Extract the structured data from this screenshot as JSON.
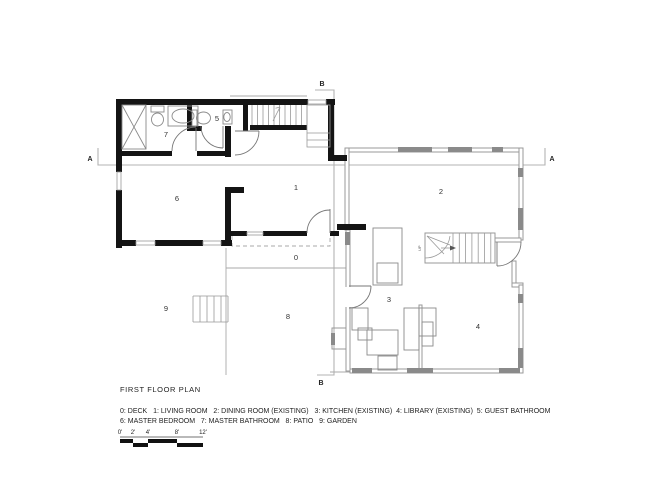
{
  "plan": {
    "title": "FIRST FLOOR PLAN",
    "section_labels": {
      "a": "A",
      "b": "B"
    },
    "rooms": [
      {
        "number": "0",
        "name": "DECK"
      },
      {
        "number": "1",
        "name": "LIVING ROOM"
      },
      {
        "number": "2",
        "name": "DINING ROOM (EXISTING)"
      },
      {
        "number": "3",
        "name": "KITCHEN (EXISTING)"
      },
      {
        "number": "4",
        "name": "LIBRARY (EXISTING)"
      },
      {
        "number": "5",
        "name": "GUEST BATHROOM"
      },
      {
        "number": "6",
        "name": "MASTER BEDROOM"
      },
      {
        "number": "7",
        "name": "MASTER BATHROOM"
      },
      {
        "number": "8",
        "name": "PATIO"
      },
      {
        "number": "9",
        "name": "GARDEN"
      }
    ],
    "stair_note": "UP",
    "legend": {
      "line1": "0: DECK   1: LIVING ROOM   2: DINING ROOM (EXISTING)   3: KITCHEN (EXISTING)  4: LIBRARY (EXISTING)  5: GUEST BATHROOM",
      "line2": "6: MASTER BEDROOM   7: MASTER BATHROOM   8: PATIO   9: GARDEN"
    },
    "scale_bar": {
      "labels": [
        "0'",
        "2'",
        "4'",
        "8'",
        "12'"
      ]
    },
    "colors": {
      "new_wall": "#141414",
      "existing_wall": "#999999",
      "section_line": "#b3b3b3",
      "text": "#333333"
    }
  }
}
